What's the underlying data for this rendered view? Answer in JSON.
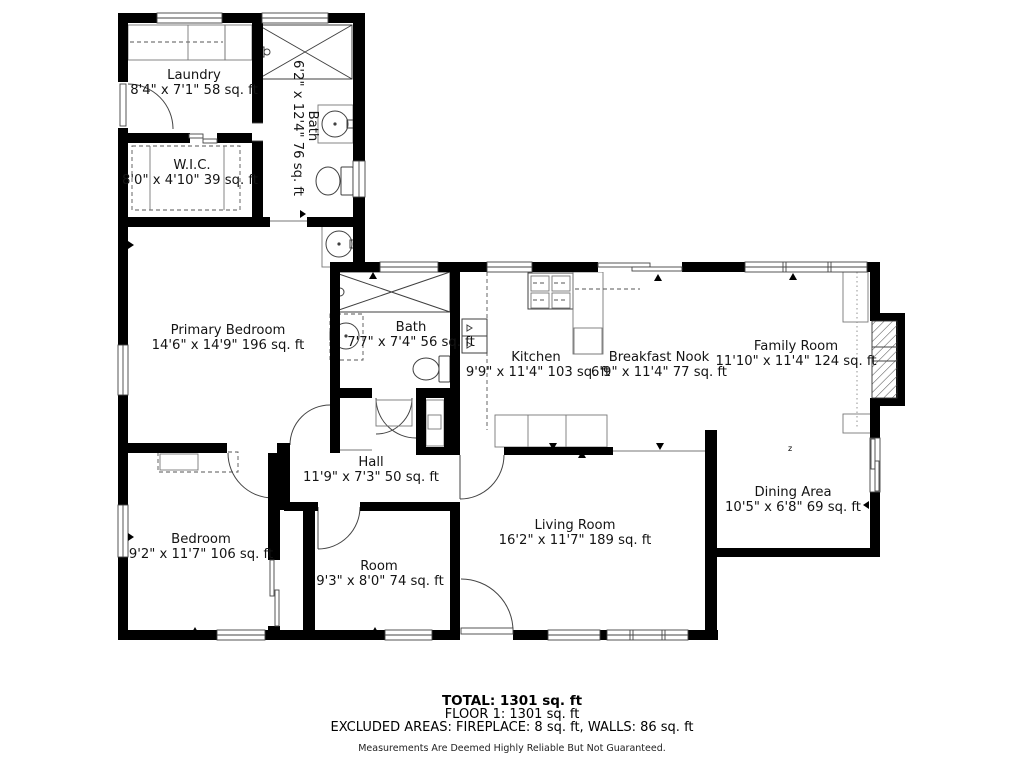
{
  "plan": {
    "rooms": {
      "laundry": {
        "name": "Laundry",
        "dims": "8'4\" x 7'1\" 58 sq. ft"
      },
      "wic": {
        "name": "W.I.C.",
        "dims": "8'0\" x 4'10\" 39 sq. ft"
      },
      "bath_upper": {
        "name": "Bath",
        "dims": "6'2\" x 12'4\" 76 sq. ft"
      },
      "primary_bedroom": {
        "name": "Primary Bedroom",
        "dims": "14'6\" x 14'9\" 196 sq. ft"
      },
      "bath_main": {
        "name": "Bath",
        "dims": "7'7\" x 7'4\" 56 sq. ft"
      },
      "kitchen": {
        "name": "Kitchen",
        "dims": "9'9\" x 11'4\" 103 sq. ft"
      },
      "breakfast_nook": {
        "name": "Breakfast Nook",
        "dims": "6'9\" x 11'4\" 77 sq. ft"
      },
      "family_room": {
        "name": "Family Room",
        "dims": "11'10\" x 11'4\" 124 sq. ft"
      },
      "dining_area": {
        "name": "Dining Area",
        "dims": "10'5\" x 6'8\" 69 sq. ft"
      },
      "hall": {
        "name": "Hall",
        "dims": "11'9\" x 7'3\" 50 sq. ft"
      },
      "bedroom": {
        "name": "Bedroom",
        "dims": "9'2\" x 11'7\" 106 sq. ft"
      },
      "room": {
        "name": "Room",
        "dims": "9'3\" x 8'0\" 74 sq. ft"
      },
      "living_room": {
        "name": "Living Room",
        "dims": "16'2\" x 11'7\" 189 sq. ft"
      }
    },
    "footer": {
      "total": "TOTAL: 1301 sq. ft",
      "floor": "FLOOR 1: 1301 sq. ft",
      "excluded": "EXCLUDED AREAS: FIREPLACE: 8 sq. ft, WALLS: 86 sq. ft",
      "disclaimer": "Measurements Are Deemed Highly Reliable But Not Guaranteed."
    },
    "colors": {
      "wall": "#000000",
      "fixture_line": "#3f3f3f",
      "background": "#ffffff"
    }
  }
}
